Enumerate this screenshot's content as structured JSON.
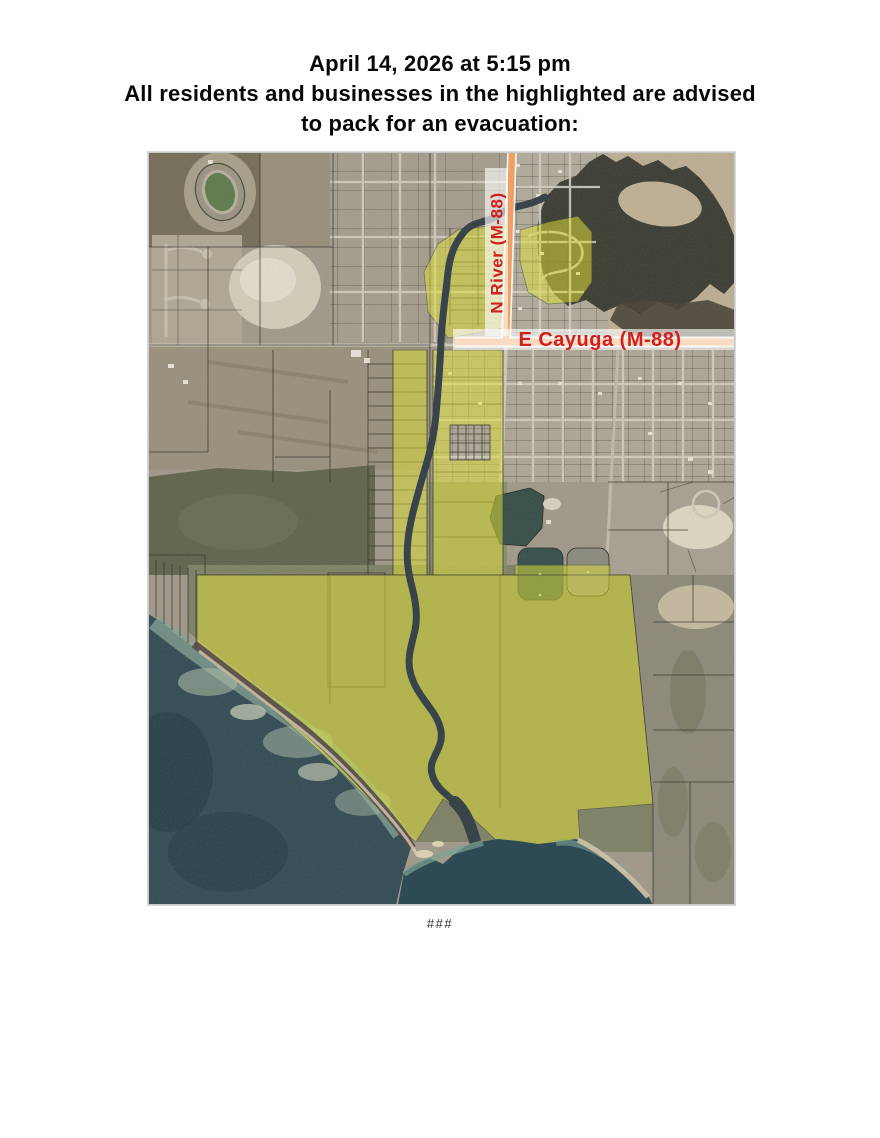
{
  "header": {
    "line1": "April 14, 2026 at 5:15 pm",
    "line2": "All residents and businesses in the highlighted are advised",
    "line3": "to pack for an evacuation:"
  },
  "map": {
    "labels": {
      "vertical_road": "N River  (M-88)",
      "horizontal_road": "E Cayuga (M-88)"
    },
    "colors": {
      "highlight_yellow": "#e9eb2f",
      "route_orange": "#ee9f63",
      "label_red": "#d02020",
      "lake_deep": "#2c4752",
      "lake_shallow": "#84a697",
      "river_dark": "#39444a",
      "marsh_water_dark": "#35372e",
      "terrain_tan": "#a29a8b"
    }
  },
  "footer": {
    "end_marker": "###"
  }
}
